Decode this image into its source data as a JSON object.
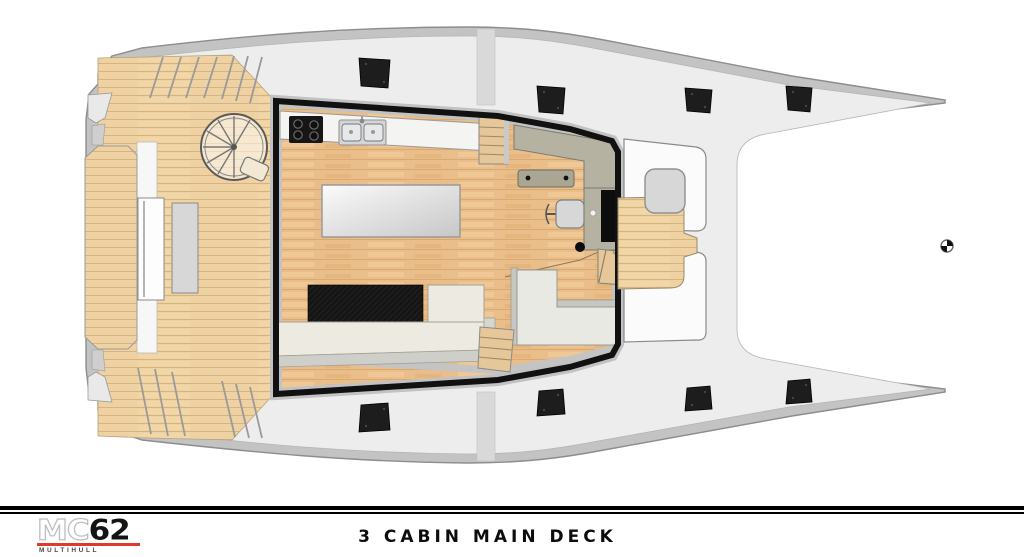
{
  "footer": {
    "logo": {
      "prefix": "MC",
      "number": "62",
      "sub": "MULTIHULL",
      "underline_color": "#e2382e"
    },
    "title": "3 CABIN MAIN DECK"
  },
  "plan": {
    "type": "catamaran-main-deck-floor-plan",
    "colors": {
      "hull_band": "#c3c3c3",
      "hull_stroke": "#8d8d8d",
      "deck": "#ededed",
      "deck_line": "#bdbdbd",
      "deck_wood": "#eed2a3",
      "deck_wood_line": "#d8b47c",
      "floor_wood": "#e9be8a",
      "floor_wood_line": "#d9a96e",
      "cabin_outline": "#111111",
      "counter": "#f4f4f2",
      "cooktop": "#161616",
      "sink": "#d3d6d8",
      "island_light": "#fbfbfb",
      "island_dark": "#c7c7c7",
      "sofa": "#edebe1",
      "dinette": "#e9e9e3",
      "rug": "#151515",
      "nav_desk": "#b6b2a1",
      "nav_bench": "#aaa694",
      "tv_panel": "#0d0d0d",
      "seat": "#d7d7d7",
      "locker": "#fbfbfb",
      "hatch": "#1d1d1d",
      "trampoline": "#ffffff",
      "stairs_wood": "#e6c79a"
    }
  }
}
